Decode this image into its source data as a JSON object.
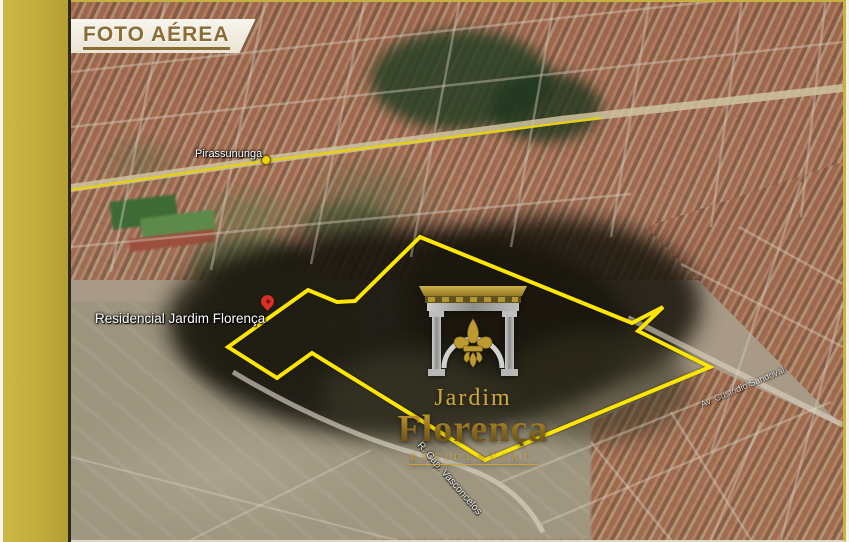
{
  "slide": {
    "title": "FOTO AÉREA"
  },
  "colors": {
    "accent_bar_gold": "#C3AC3C",
    "title_text": "#8A6D35",
    "boundary_yellow": "#FFE600",
    "route_yellow": "#E8D400",
    "logo_gold": "#C9A437",
    "pin_red": "#D93025",
    "city_marker_yellow": "#F0D000"
  },
  "map": {
    "city_label": "Pirassununga",
    "place_label": "Residencial Jardim Florença",
    "streets": {
      "bottom": "R. Cap. Vasconcelos",
      "right": "Av. Custódio Sandoval"
    }
  },
  "logo": {
    "line1": "Jardim",
    "line2": "Florença",
    "tagline": "RESIDENCIAL"
  },
  "property_outline": {
    "stroke": "#FFE600",
    "stroke_width": 4,
    "points": [
      [
        349,
        235
      ],
      [
        561,
        321
      ],
      [
        592,
        305
      ],
      [
        567,
        329
      ],
      [
        639,
        365
      ],
      [
        414,
        458
      ],
      [
        241,
        351
      ],
      [
        206,
        376
      ],
      [
        157,
        345
      ],
      [
        237,
        288
      ],
      [
        266,
        300
      ],
      [
        284,
        299
      ]
    ]
  }
}
